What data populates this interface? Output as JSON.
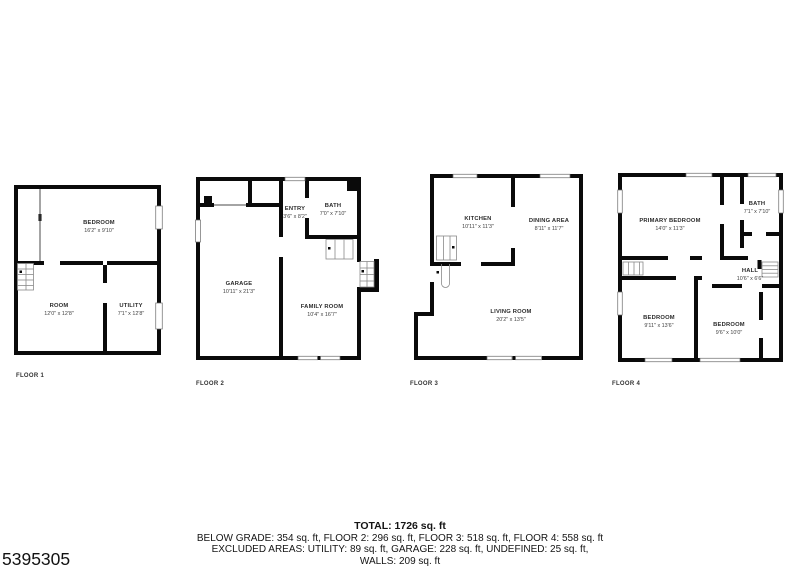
{
  "listing_id": "5395305",
  "colors": {
    "wall": "#0a0a0a",
    "background": "#ffffff"
  },
  "floors": [
    {
      "label": "FLOOR 1",
      "rooms": {
        "bedroom": {
          "name": "BEDROOM",
          "dims": "16'2\" x 9'10\""
        },
        "room": {
          "name": "ROOM",
          "dims": "12'0\" x 12'8\""
        },
        "utility": {
          "name": "UTILITY",
          "dims": "7'1\" x 12'8\""
        }
      }
    },
    {
      "label": "FLOOR 2",
      "rooms": {
        "entry": {
          "name": "ENTRY",
          "dims": "3'6\" x 8'2\""
        },
        "bath": {
          "name": "BATH",
          "dims": "7'0\" x 7'10\""
        },
        "garage": {
          "name": "GARAGE",
          "dims": "10'11\" x 21'3\""
        },
        "family_room": {
          "name": "FAMILY ROOM",
          "dims": "10'4\" x 16'7\""
        }
      }
    },
    {
      "label": "FLOOR 3",
      "rooms": {
        "kitchen": {
          "name": "KITCHEN",
          "dims": "10'11\" x 11'3\""
        },
        "dining_area": {
          "name": "DINING AREA",
          "dims": "8'11\" x 11'7\""
        },
        "living_room": {
          "name": "LIVING ROOM",
          "dims": "20'2\" x 13'5\""
        }
      }
    },
    {
      "label": "FLOOR 4",
      "rooms": {
        "primary_bedroom": {
          "name": "PRIMARY BEDROOM",
          "dims": "14'0\" x 11'3\""
        },
        "bath": {
          "name": "BATH",
          "dims": "7'1\" x 7'10\""
        },
        "hall": {
          "name": "HALL",
          "dims": "10'6\" x 6'6\""
        },
        "bedroom_left": {
          "name": "BEDROOM",
          "dims": "9'11\" x 13'6\""
        },
        "bedroom_right": {
          "name": "BEDROOM",
          "dims": "9'6\" x 10'0\""
        }
      }
    }
  ],
  "summary": {
    "total": "TOTAL: 1726 sq. ft",
    "by_floor": "BELOW GRADE: 354 sq. ft, FLOOR 2: 296 sq. ft, FLOOR 3: 518 sq. ft, FLOOR 4: 558 sq. ft",
    "excluded": "EXCLUDED AREAS: UTILITY: 89 sq. ft, GARAGE: 228 sq. ft, UNDEFINED: 25 sq. ft,",
    "walls": "WALLS: 209 sq. ft"
  }
}
